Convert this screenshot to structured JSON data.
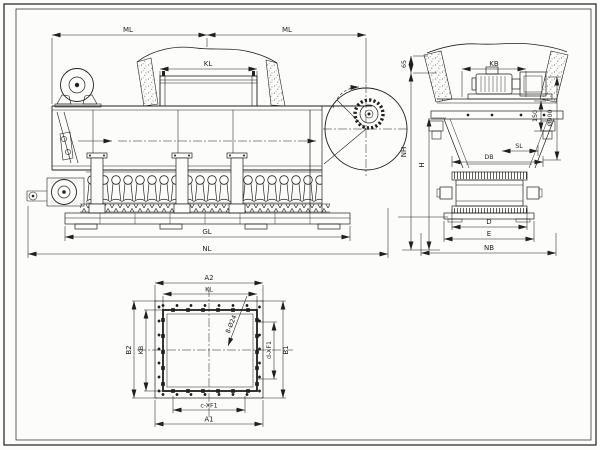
{
  "colors": {
    "ink": "#1f1f1f",
    "paper": "#fcfcfa"
  },
  "side_view": {
    "ml_left": "ML",
    "ml_right": "ML",
    "kl": "KL",
    "gl": "GL",
    "nl": "NL"
  },
  "end_view": {
    "kb": "KB",
    "rim_height": "65",
    "nh": "NH",
    "h": "H",
    "sl": "SL",
    "db": "DB",
    "s150": "150",
    "dia900": "Ø900",
    "d": "D",
    "e": "E",
    "nb": "NB"
  },
  "plan_view": {
    "a2": "A2",
    "kl": "KL",
    "b2": "B2",
    "kb": "KB",
    "b1": "B1",
    "d_xf1": "d-XF1",
    "c_xf1": "c-XF1",
    "a1": "A1",
    "bolt_note": "8-Ø24"
  }
}
